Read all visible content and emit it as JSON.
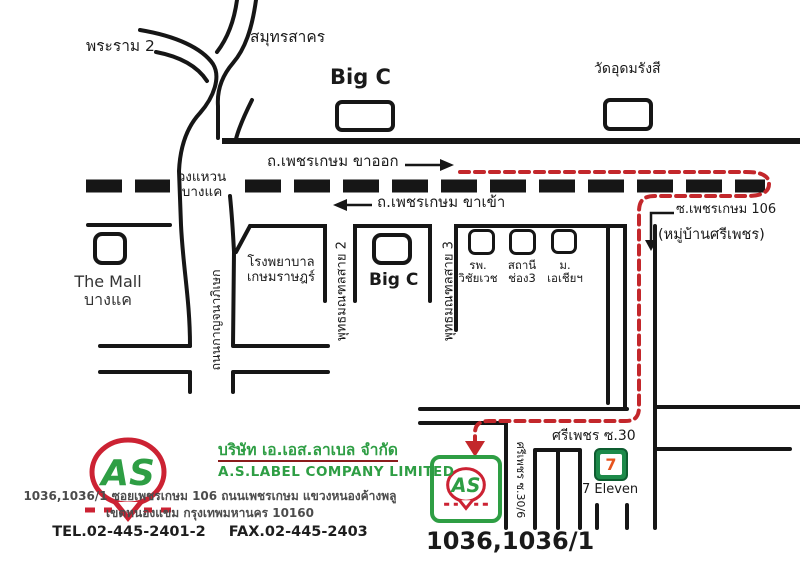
{
  "colors": {
    "route_red": "#c3272b",
    "brand_green": "#2e9e44",
    "logo_red": "#cc2233",
    "line_black": "#161616",
    "seven_green": "#1d8a4a",
    "seven_orange": "#e6541e"
  },
  "labels": {
    "rama2": "พระราม 2",
    "samut_sakhon": "สมุทรสาคร",
    "bigc_top": "Big C",
    "wat": "วัดอุดมรังสี",
    "phetkasem_outbound": "ถ.เพชรเกษม ขาออก",
    "phetkasem_inbound": "ถ.เพชรเกษม ขาเข้า",
    "ringroad_line1": "วงแหวน",
    "ringroad_line2": "บางแค",
    "the_mall_line1": "The Mall",
    "the_mall_line2": "บางแค",
    "hospital_line1": "โรงพยาบาล",
    "hospital_line2": "เกษมราษฎร์",
    "sai2": "พุทธมณฑลสาย 2",
    "sai3": "พุทธมณฑลสาย 3",
    "kanchanaphisek": "ถนนกาญจนาภิเษก",
    "bigc_lower": "Big C",
    "poi1_line1": "รพ.",
    "poi1_line2": "วิชัยเวช",
    "poi2_line1": "สถานี",
    "poi2_line2": "ช่อง3",
    "poi3_line1": "ม.",
    "poi3_line2": "เอเชียฯ",
    "soi106": "ซ.เพชรเกษม 106",
    "village": "(หมู่บ้านศรีเพชร)",
    "sripetch30": "ศรีเพชร ซ.30",
    "sripetch306": "ศรีเพชร ซ.30/6",
    "seven_eleven": "7 Eleven",
    "seven_glyph": "7",
    "house_no": "1036,1036/1"
  },
  "company": {
    "logo_text": "AS",
    "name_th": "บริษัท เอ.เอส.ลาเบล จำกัด",
    "name_en": "A.S.LABEL COMPANY LIMITED",
    "address1": "1036,1036/1 ซอยเพชรเกษม 106 ถนนเพชรเกษม  แขวงหนองค้างพลู",
    "address2": "เขตหนองแขม กรุงเทพมหานคร 10160",
    "tel": "TEL.02-445-2401-2",
    "fax": "FAX.02-445-2403"
  }
}
